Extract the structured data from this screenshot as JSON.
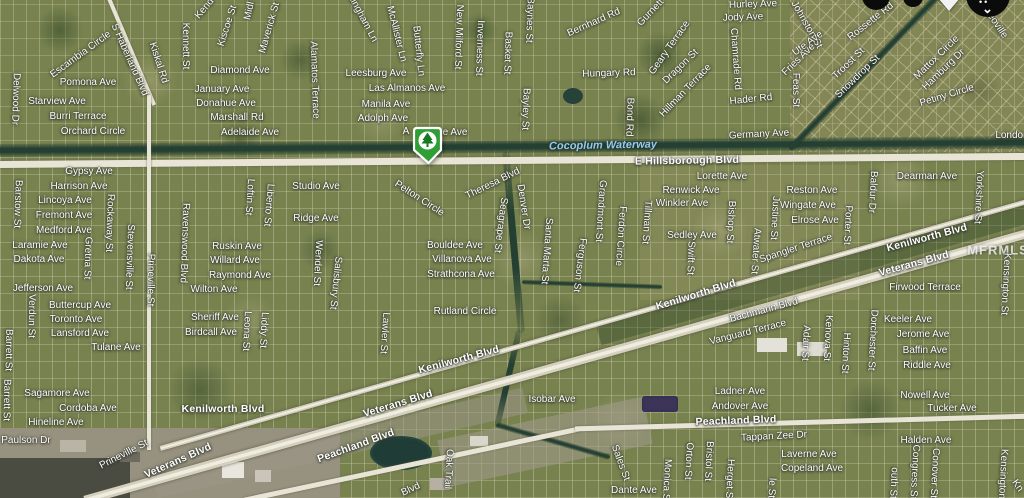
{
  "map": {
    "watermark": "MFRMLS",
    "marker": {
      "type": "listing-pin",
      "shape": "green-shield",
      "icon": "tree-icon",
      "color": "#2f9e35",
      "inner": "#ffffff",
      "tree_color": "#157a20"
    },
    "controls_top_right": [
      "circle-button",
      "circle-button",
      "arrow-down-icon",
      "circle-chevron-button"
    ],
    "colors": {
      "map_base": "#77824f",
      "grid_line": "#d2cbaf",
      "road": "#e9e5d6",
      "highway": "#efece0",
      "waterway": "#244033",
      "street_label": "#ffffff",
      "waterway_label": "#8ecdf2",
      "watermark": "#ecece8",
      "control": "#0b0b0b",
      "pond_purple": "#3c3558"
    },
    "labels": [
      [
        "Escambia Circle",
        81,
        55,
        -36
      ],
      [
        "Pomona Ave",
        88,
        83,
        0
      ],
      [
        "Starview Ave",
        57,
        102,
        0
      ],
      [
        "Burri Terrace",
        78,
        117,
        0
      ],
      [
        "Orchard Circle",
        93,
        132,
        0
      ],
      [
        "Delwood Dr",
        15,
        99,
        92
      ],
      [
        "S Haberland Blvd",
        129,
        60,
        66
      ],
      [
        "Kiskal Rd",
        158,
        63,
        72
      ],
      [
        "Kennett St",
        185,
        46,
        90
      ],
      [
        "Kiscoe St",
        228,
        26,
        -72
      ],
      [
        "Kend",
        205,
        9,
        -50
      ],
      [
        "Midl",
        250,
        11,
        -78
      ],
      [
        "Maverick St",
        270,
        28,
        -74
      ],
      [
        "Alamatos Terrace",
        314,
        80,
        88
      ],
      [
        "lingham Ln",
        363,
        20,
        62
      ],
      [
        "McAllister Ln",
        396,
        34,
        76
      ],
      [
        "Butterfly Ln",
        418,
        51,
        84
      ],
      [
        "Diamond Ave",
        240,
        71,
        0
      ],
      [
        "January Ave",
        222,
        90,
        0
      ],
      [
        "Donahue Ave",
        226,
        104,
        0
      ],
      [
        "Marshall Rd",
        237,
        118,
        0
      ],
      [
        "Adelaide Ave",
        250,
        133,
        0
      ],
      [
        "Leesburg Ave",
        376,
        74,
        0
      ],
      [
        "Las Almanos Ave",
        407,
        89,
        0
      ],
      [
        "Manila Ave",
        386,
        105,
        0
      ],
      [
        "Adolph Ave",
        383,
        119,
        0
      ],
      [
        "A",
        406,
        132,
        0
      ],
      [
        "e Ave",
        455,
        133,
        0
      ],
      [
        "New Milford St",
        458,
        37,
        92
      ],
      [
        "Inverness St",
        479,
        48,
        92
      ],
      [
        "Basket St",
        507,
        53,
        92
      ],
      [
        "Baynes St",
        529,
        20,
        92
      ],
      [
        "Bayley St",
        525,
        109,
        92
      ],
      [
        "Bernhard Rd",
        594,
        23,
        -24
      ],
      [
        "Hungary Rd",
        609,
        74,
        -2
      ],
      [
        "Bond Rd",
        629,
        117,
        92
      ],
      [
        "Gurnett",
        651,
        13,
        -46
      ],
      [
        "Geary Terrace",
        670,
        48,
        -55
      ],
      [
        "Hurley Ave",
        753,
        5,
        -2
      ],
      [
        "Jody Ave",
        743,
        18,
        -2
      ],
      [
        "Johnston St",
        806,
        25,
        60
      ],
      [
        "Ute Ave",
        808,
        44,
        -36
      ],
      [
        "Fries Ave",
        799,
        60,
        -44
      ],
      [
        "Dragon St",
        681,
        67,
        -44
      ],
      [
        "Chamrade Rd",
        735,
        59,
        86
      ],
      [
        "Hillman Terrace",
        686,
        91,
        -46
      ],
      [
        "Hader Rd",
        751,
        100,
        -6
      ],
      [
        "Feas St",
        795,
        90,
        90
      ],
      [
        "Germany Ave",
        759,
        135,
        -3
      ],
      [
        "Rossette Rd",
        871,
        22,
        -38
      ],
      [
        "Troost St",
        849,
        64,
        -44
      ],
      [
        "Snowdrop St",
        858,
        77,
        -44
      ],
      [
        "Mattox Circle",
        937,
        58,
        -44
      ],
      [
        "Hamburg Dr",
        944,
        70,
        -44
      ],
      [
        "Petiny Circle",
        947,
        96,
        -17
      ],
      [
        "eoville",
        997,
        26,
        56
      ],
      [
        "London",
        1012,
        136,
        0
      ],
      [
        "Cocoplum Waterway",
        603,
        146,
        -1,
        "wt"
      ],
      [
        "E Hillsborough Blvd",
        687,
        161,
        -1,
        "rd"
      ],
      [
        "Gypsy Ave",
        89,
        172,
        0
      ],
      [
        "Harrison Ave",
        79,
        187,
        0
      ],
      [
        "Lincoya Ave",
        65,
        201,
        0
      ],
      [
        "Fremont Ave",
        64,
        216,
        0
      ],
      [
        "Medford Ave",
        64,
        231,
        0
      ],
      [
        "Laramie Ave",
        40,
        246,
        0
      ],
      [
        "Dakota Ave",
        39,
        260,
        0
      ],
      [
        "Jefferson Ave",
        43,
        289,
        0
      ],
      [
        "Buttercup Ave",
        80,
        306,
        0
      ],
      [
        "Toronto Ave",
        76,
        320,
        0
      ],
      [
        "Lansford Ave",
        80,
        334,
        0
      ],
      [
        "Tulane Ave",
        116,
        348,
        0
      ],
      [
        "Barstow St",
        17,
        204,
        92
      ],
      [
        "Rockaway St",
        109,
        223,
        92
      ],
      [
        "Gretna St",
        87,
        258,
        92
      ],
      [
        "Stevensville St",
        129,
        257,
        92
      ],
      [
        "Prineville St",
        150,
        280,
        91
      ],
      [
        "Verdun St",
        31,
        316,
        91
      ],
      [
        "Barrett St",
        8,
        350,
        91
      ],
      [
        "Barrett St",
        6,
        400,
        91
      ],
      [
        "Sagamore Ave",
        57,
        394,
        0
      ],
      [
        "Cordoba Ave",
        88,
        409,
        0
      ],
      [
        "Hineline Ave",
        56,
        423,
        0
      ],
      [
        "Paulson Dr",
        26,
        441,
        0
      ],
      [
        "Prineville St",
        124,
        455,
        -27
      ],
      [
        "Veterans Blvd",
        178,
        461,
        -24,
        "rd"
      ],
      [
        "Ravenswood Blvd",
        184,
        243,
        92
      ],
      [
        "Loftin St",
        249,
        197,
        94
      ],
      [
        "Liberto St",
        268,
        205,
        95
      ],
      [
        "Studio Ave",
        316,
        187,
        0
      ],
      [
        "Ridge Ave",
        316,
        219,
        0
      ],
      [
        "Ruskin Ave",
        237,
        247,
        0
      ],
      [
        "Willard Ave",
        235,
        261,
        0
      ],
      [
        "Raymond Ave",
        240,
        276,
        0
      ],
      [
        "Wilton Ave",
        214,
        290,
        0
      ],
      [
        "Sheriff Ave",
        215,
        318,
        0
      ],
      [
        "Birdcall Ave",
        211,
        333,
        0
      ],
      [
        "Leona St",
        246,
        331,
        93
      ],
      [
        "Liddy St",
        263,
        330,
        93
      ],
      [
        "Wendel St",
        317,
        263,
        93
      ],
      [
        "Salisbury St",
        335,
        283,
        96
      ],
      [
        "Lawler St",
        384,
        333,
        94
      ],
      [
        "Pelton Circle",
        419,
        199,
        33
      ],
      [
        "Theresa Blvd",
        493,
        184,
        -26
      ],
      [
        "Seagrape St",
        500,
        225,
        97
      ],
      [
        "Denver Dr",
        523,
        207,
        81
      ],
      [
        "Santa Marta St",
        546,
        251,
        94
      ],
      [
        "Ferguson St",
        579,
        265,
        97
      ],
      [
        "Grandmont St",
        600,
        211,
        94
      ],
      [
        "Ferdon Circle",
        620,
        236,
        94
      ],
      [
        "Tillman St",
        646,
        222,
        94
      ],
      [
        "Bouldee Ave",
        455,
        246,
        0
      ],
      [
        "Villanova Ave",
        462,
        260,
        0
      ],
      [
        "Strathcona Ave",
        461,
        275,
        0
      ],
      [
        "Rutland Circle",
        465,
        312,
        0
      ],
      [
        "Lorette Ave",
        722,
        177,
        0
      ],
      [
        "Renwick Ave",
        691,
        191,
        0
      ],
      [
        "Winkler Ave",
        682,
        204,
        0
      ],
      [
        "Reston Ave",
        812,
        191,
        0
      ],
      [
        "Wingate Ave",
        808,
        206,
        0
      ],
      [
        "Elrose Ave",
        815,
        221,
        0
      ],
      [
        "Sedley Ave",
        692,
        236,
        0
      ],
      [
        "Swift St",
        690,
        258,
        92
      ],
      [
        "Bishop St",
        730,
        222,
        93
      ],
      [
        "Atwater St",
        755,
        251,
        94
      ],
      [
        "Justine St",
        774,
        218,
        93
      ],
      [
        "Porter St",
        847,
        225,
        93
      ],
      [
        "Spangler Terrace",
        796,
        249,
        -18
      ],
      [
        "Kenilworth Blvd",
        696,
        295,
        -17,
        "rd"
      ],
      [
        "Bachmann Blvd",
        764,
        311,
        -15
      ],
      [
        "Vanguard Terrace",
        748,
        333,
        -14
      ],
      [
        "Dearman Ave",
        927,
        177,
        0
      ],
      [
        "Baldur Dr",
        872,
        192,
        93
      ],
      [
        "Yorkshire St",
        978,
        197,
        93
      ],
      [
        "Kenilworth Blvd",
        927,
        238,
        -15,
        "rd"
      ],
      [
        "Veterans Blvd",
        914,
        264,
        -15,
        "rd"
      ],
      [
        "MFRMLS",
        998,
        250,
        0,
        "wm"
      ],
      [
        "Firwood Terrace",
        925,
        288,
        0
      ],
      [
        "Keeler Ave",
        908,
        320,
        0
      ],
      [
        "Jerome Ave",
        923,
        335,
        0
      ],
      [
        "Baffin Ave",
        925,
        351,
        0
      ],
      [
        "Riddle Ave",
        927,
        366,
        0
      ],
      [
        "Kensington St",
        1005,
        284,
        93
      ],
      [
        "Dorchester St",
        872,
        340,
        93
      ],
      [
        "Kenilworth Blvd",
        223,
        409,
        0,
        "rd"
      ],
      [
        "Veterans Blvd",
        398,
        404,
        -17,
        "rd"
      ],
      [
        "Kenilworth Blvd",
        459,
        360,
        -15,
        "rd"
      ],
      [
        "Isobar Ave",
        552,
        400,
        0
      ],
      [
        "Peachland Blvd",
        356,
        446,
        -20,
        "rd"
      ],
      [
        "Peachland Blvd",
        736,
        421,
        -2,
        "rd"
      ],
      [
        "Adair St",
        805,
        343,
        93
      ],
      [
        "Kenova St",
        827,
        338,
        93
      ],
      [
        "Hinton St",
        845,
        353,
        93
      ],
      [
        "Ladner Ave",
        740,
        392,
        0
      ],
      [
        "Andover Ave",
        740,
        407,
        0
      ],
      [
        "Tappan Zee Dr",
        774,
        437,
        -3
      ],
      [
        "Laverne Ave",
        809,
        455,
        0
      ],
      [
        "Copeland Ave",
        812,
        469,
        0
      ],
      [
        "Nowell Ave",
        925,
        396,
        0
      ],
      [
        "Tucker Ave",
        952,
        409,
        0
      ],
      [
        "Halden Ave",
        926,
        441,
        0
      ],
      [
        "outh St",
        893,
        483,
        93
      ],
      [
        "Congress St",
        914,
        472,
        93
      ],
      [
        "Conover St",
        934,
        473,
        93
      ],
      [
        "Kensington St",
        1002,
        480,
        93
      ],
      [
        "Kn",
        1017,
        486,
        55
      ],
      [
        "Orton St",
        688,
        461,
        93
      ],
      [
        "Bristol St",
        708,
        461,
        93
      ],
      [
        "Herget St",
        729,
        480,
        93
      ],
      [
        "le St",
        771,
        488,
        93
      ],
      [
        "Dante Ave",
        634,
        491,
        0
      ],
      [
        "Sales St",
        620,
        463,
        70
      ],
      [
        "Monica St",
        666,
        481,
        93
      ],
      [
        "Oak Trail",
        448,
        469,
        93
      ],
      [
        "Blvd",
        411,
        490,
        -25
      ]
    ]
  }
}
